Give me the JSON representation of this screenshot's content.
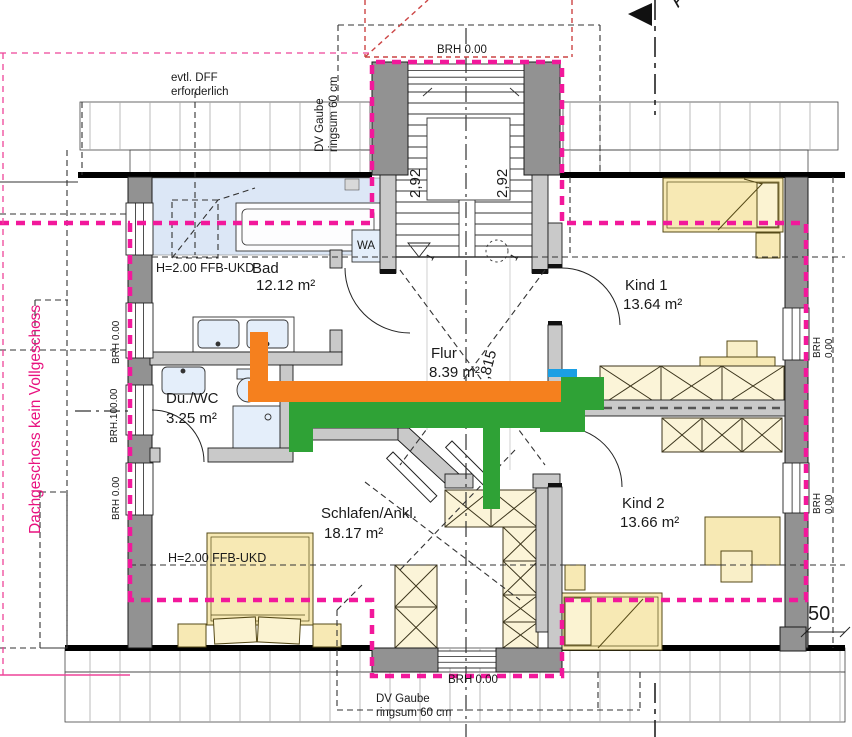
{
  "drawing": {
    "side_note": "Dachgeschoss kein Vollgeschoss",
    "rooms": [
      {
        "name": "Bad",
        "area": "12.12 m²"
      },
      {
        "name": "Du./WC",
        "area": "3.25 m²"
      },
      {
        "name": "Flur",
        "area": "8.39 m²"
      },
      {
        "name": "Kind 1",
        "area": "13.64 m²"
      },
      {
        "name": "Kind 2",
        "area": "13.66 m²"
      },
      {
        "name": "Schlafen/Ankl.",
        "area": "18.17 m²"
      }
    ],
    "notes": {
      "dff": "evtl. DFF\nerforderlich",
      "gaube_top": "DV Gaube\nringsum 60 cm",
      "gaube_bottom": "DV Gaube\nringsum 60 cm",
      "ffb_bad": "H=2.00 FFB-UKD",
      "ffb_schlafen": "H=2.00 FFB-UKD",
      "washer": "WA"
    },
    "sills": {
      "top": "BRH 0.00",
      "bottom": "BRH 0.00",
      "left_1": "BRH 0.00",
      "left_2": "BRH.100.00",
      "left_3": "BRH 0.00",
      "right_1": "BRH 0.00",
      "right_2": "BRH 0.00"
    },
    "dims": {
      "stair_left": "2,92",
      "stair_right": "2,92",
      "diagonal": ",815",
      "eave_offset": "50"
    },
    "stairs": {
      "step_left": "1",
      "step_right": "1"
    },
    "section": {
      "letter": "A"
    },
    "colors": {
      "magenta": "#f2189b",
      "pink": "#ee4499",
      "side_note_pink": "#e8117f",
      "red_dashed": "#cc4444",
      "overlay_orange": "#f5801e",
      "overlay_green": "#2fa236",
      "overlay_blue": "#1b9fe4",
      "wall_dark": "#929292",
      "wall_light": "#c9c9c9",
      "furniture_yellow": "#f7e9b4",
      "fixture_blue": "#e4eefa",
      "tile_blue": "#dce7f6"
    }
  }
}
